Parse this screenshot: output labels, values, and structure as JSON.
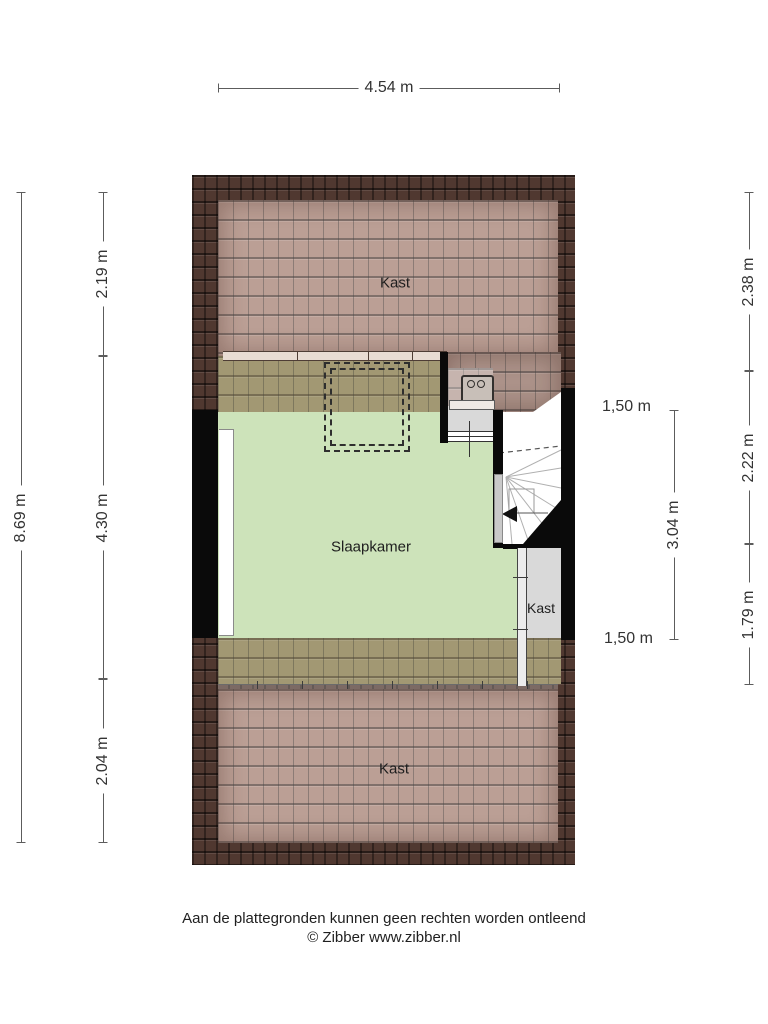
{
  "plan": {
    "rooms": {
      "kast_top": "Kast",
      "slaapkamer": "Slaapkamer",
      "kast_right": "Kast",
      "kast_bottom": "Kast"
    },
    "dimensions": {
      "top_width": "4.54 m",
      "left_total": "8.69 m",
      "left_top": "2.19 m",
      "left_middle": "4.30 m",
      "left_bottom": "2.04 m",
      "right_top": "2.38 m",
      "right_middle": "2.22 m",
      "right_bottom": "1.79 m",
      "stair_height": "3.04 m",
      "headroom_top": "1,50 m",
      "headroom_bottom": "1,50 m"
    },
    "colors": {
      "roof_dark": "#503830",
      "roof_light": "#bb9f95",
      "roof_over_room": "#a29873",
      "room_green": "#cde3ba",
      "closet_gray": "#d9d9d9",
      "wall_black": "#0a0a0a"
    }
  },
  "footer": {
    "line1": "Aan de plattegronden kunnen geen rechten worden ontleend",
    "line2": "© Zibber www.zibber.nl"
  }
}
